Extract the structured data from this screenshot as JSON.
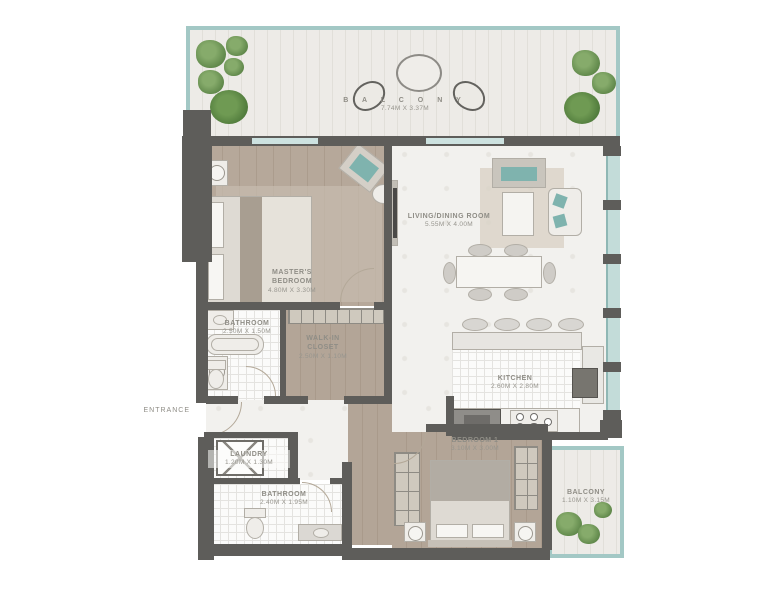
{
  "plan": {
    "entrance_label": "ENTRANCE",
    "rooms": [
      {
        "key": "balcony-top",
        "name": "B A L C O N Y",
        "dims": "7.74M X 3.37M"
      },
      {
        "key": "master-bedroom",
        "name": "MASTER'S BEDROOM",
        "dims": "4.80M X 3.30M"
      },
      {
        "key": "living-dining",
        "name": "LIVING/DINING ROOM",
        "dims": "5.55M X 4.00M"
      },
      {
        "key": "bathroom-1",
        "name": "BATHROOM",
        "dims": "2.50M X 1.50M"
      },
      {
        "key": "walk-in-closet",
        "name": "WALK-IN CLOSET",
        "dims": "2.50M X 1.10M"
      },
      {
        "key": "kitchen",
        "name": "KITCHEN",
        "dims": "2.60M X 2.80M"
      },
      {
        "key": "bedroom-1",
        "name": "BEDROOM 1",
        "dims": "3.10M X 3.00M"
      },
      {
        "key": "laundry",
        "name": "LAUNDRY",
        "dims": "1.20M X 1.30M"
      },
      {
        "key": "bathroom-2",
        "name": "BATHROOM",
        "dims": "2.40M X 1.95M"
      },
      {
        "key": "balcony-bottom",
        "name": "BALCONY",
        "dims": "1.10M X 3.15M"
      }
    ],
    "colors": {
      "wall": "#5e5d5a",
      "glass_frame": "#a3c8c5",
      "glass_panel": "#c3dcd9",
      "wood_floor": "#b6a89a",
      "marble_floor": "#f2f1ee",
      "plank_floor": "#edebe7",
      "label_text": "#8f8d86",
      "accent_teal": "#7fb3ae",
      "plant_green": "#4b7539"
    }
  }
}
